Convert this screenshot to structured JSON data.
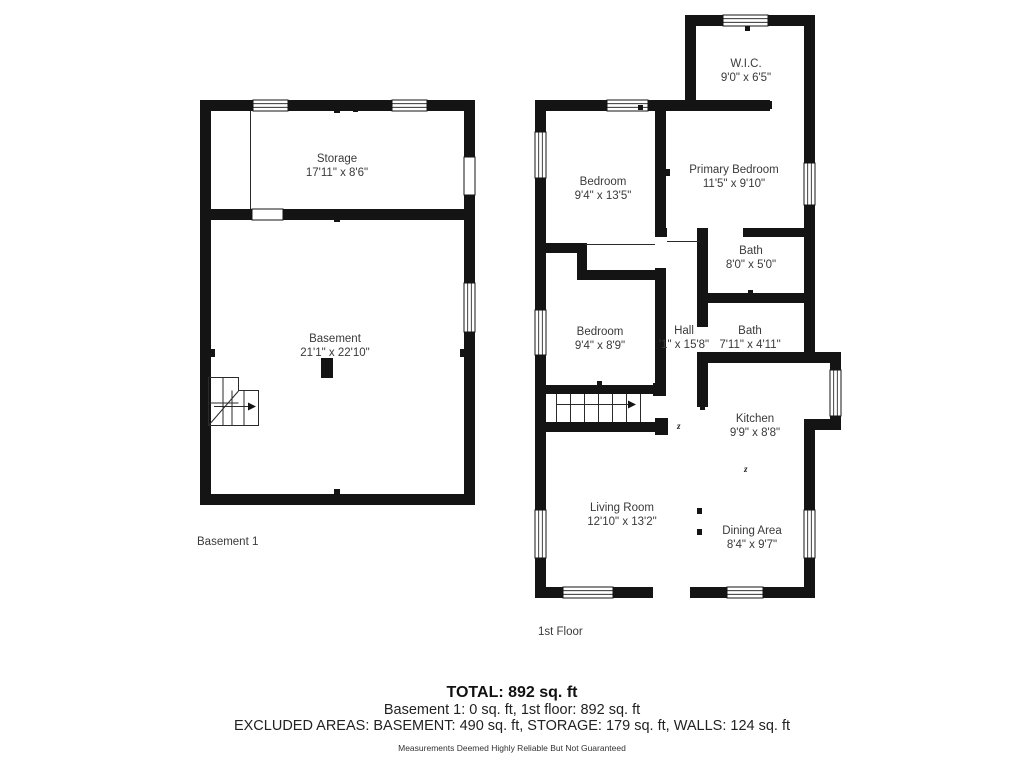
{
  "colors": {
    "wall": "#141414",
    "text": "#3a3a3a",
    "background": "#ffffff"
  },
  "plans": {
    "basement": {
      "label": "Basement 1",
      "rooms": [
        {
          "name": "Storage",
          "dims": "17'11\" x 8'6\""
        },
        {
          "name": "Basement",
          "dims": "21'1\" x 22'10\""
        }
      ]
    },
    "first_floor": {
      "label": "1st Floor",
      "opening_mark": "z",
      "rooms": [
        {
          "name": "W.I.C.",
          "dims": "9'0\" x 6'5\""
        },
        {
          "name": "Bedroom",
          "dims": "9'4\" x 13'5\""
        },
        {
          "name": "Primary Bedroom",
          "dims": "11'5\" x 9'10\""
        },
        {
          "name": "Bath",
          "dims": "8'0\" x 5'0\""
        },
        {
          "name": "Bedroom",
          "dims": "9'4\" x 8'9\""
        },
        {
          "name": "Hall",
          "dims": "'1\" x 15'8\""
        },
        {
          "name": "Bath",
          "dims": "7'11\" x 4'11\""
        },
        {
          "name": "Kitchen",
          "dims": "9'9\" x 8'8\""
        },
        {
          "name": "Living Room",
          "dims": "12'10\" x 13'2\""
        },
        {
          "name": "Dining Area",
          "dims": "8'4\" x 9'7\""
        }
      ]
    }
  },
  "summary": {
    "total": "TOTAL: 892 sq. ft",
    "floors": "Basement 1: 0 sq. ft, 1st floor: 892 sq. ft",
    "excluded": "EXCLUDED AREAS: BASEMENT: 490 sq. ft, STORAGE: 179 sq. ft, WALLS: 124 sq. ft",
    "disclaimer": "Measurements Deemed Highly Reliable But Not Guaranteed"
  }
}
